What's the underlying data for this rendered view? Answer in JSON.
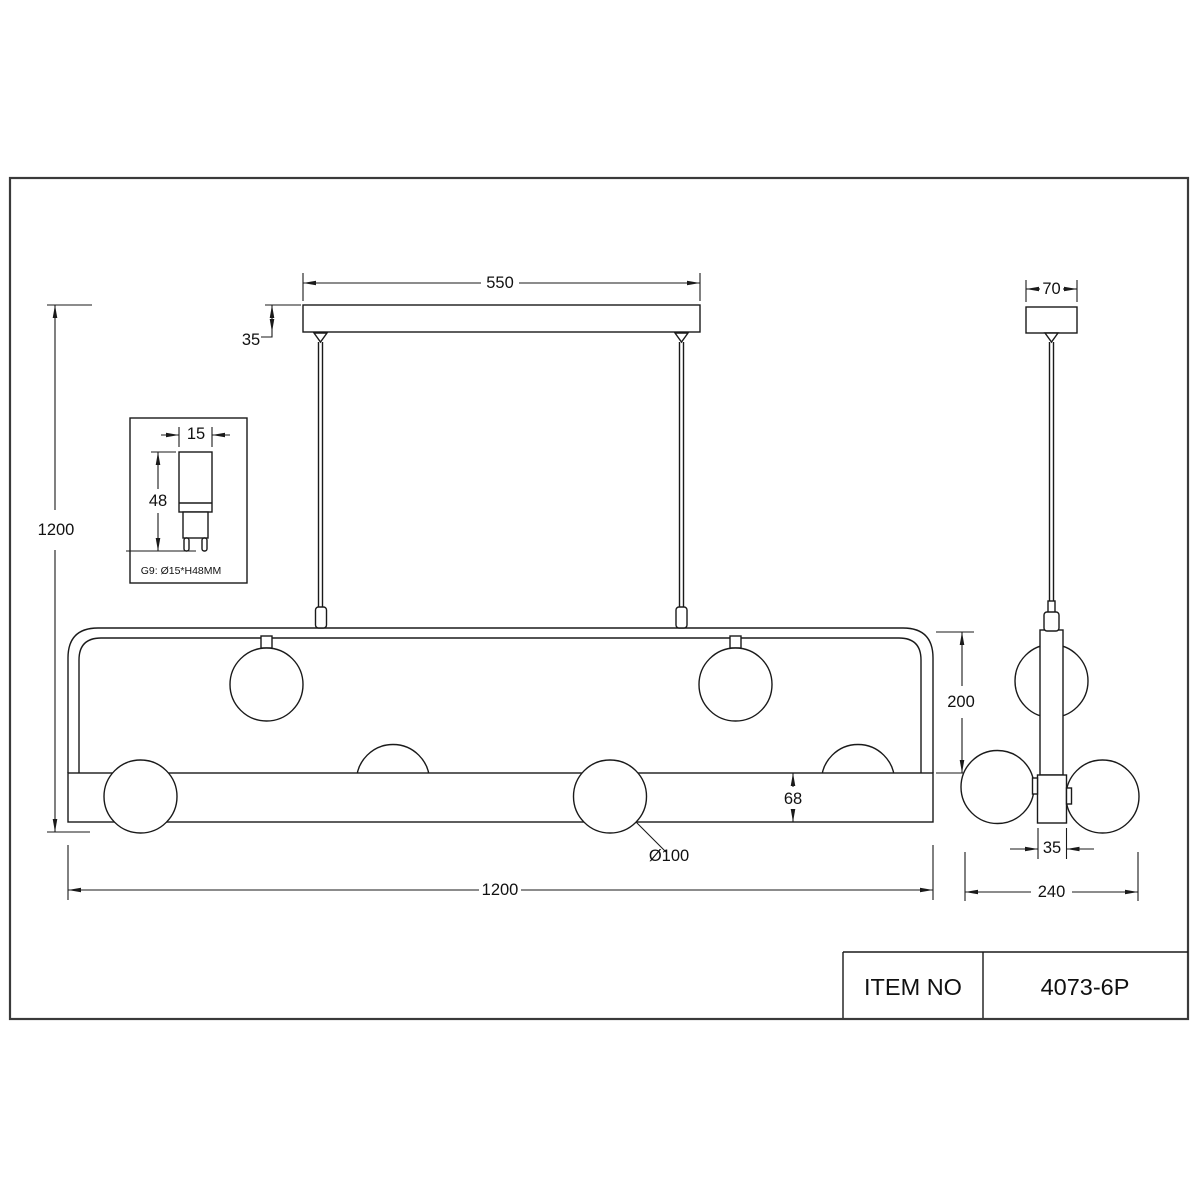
{
  "title_block": {
    "label": "ITEM NO",
    "value": "4073-6P"
  },
  "front_view": {
    "canopy_width": "550",
    "canopy_thickness": "35",
    "overall_height": "1200",
    "fixture_length": "1200",
    "frame_height": "200",
    "bar_thickness": "68",
    "globe_diameter": "Ø100"
  },
  "side_view": {
    "canopy_width": "70",
    "bar_depth": "35",
    "overall_depth": "240"
  },
  "bulb_detail": {
    "bulb_width": "15",
    "bulb_height": "48",
    "caption": "G9: Ø15*H48MM"
  }
}
